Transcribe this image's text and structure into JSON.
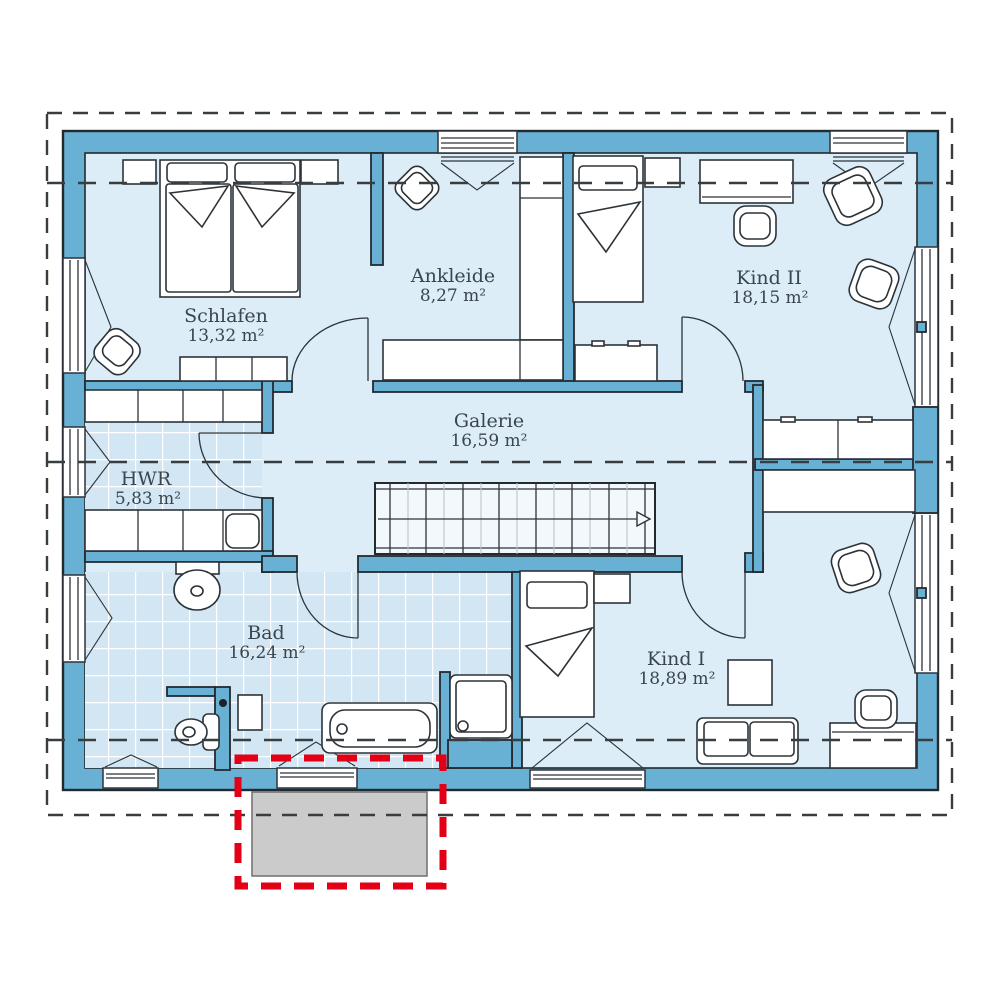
{
  "plan": {
    "rooms": [
      {
        "name": "Schlafen",
        "area": "13,32 m²"
      },
      {
        "name": "Ankleide",
        "area": "8,27 m²"
      },
      {
        "name": "Kind II",
        "area": "18,15 m²"
      },
      {
        "name": "Galerie",
        "area": "16,59 m²"
      },
      {
        "name": "HWR",
        "area": "5,83 m²"
      },
      {
        "name": "Bad",
        "area": "16,24 m²"
      },
      {
        "name": "Kind I",
        "area": "18,89 m²"
      }
    ],
    "colors": {
      "wall_blue": "#68b1d5",
      "floor_light": "#dcedf8",
      "tile_blue": "#d2e7f3",
      "highlight_red": "#e30016",
      "dormer_gray": "#cbcbcb",
      "line_dark": "#383d40"
    }
  }
}
